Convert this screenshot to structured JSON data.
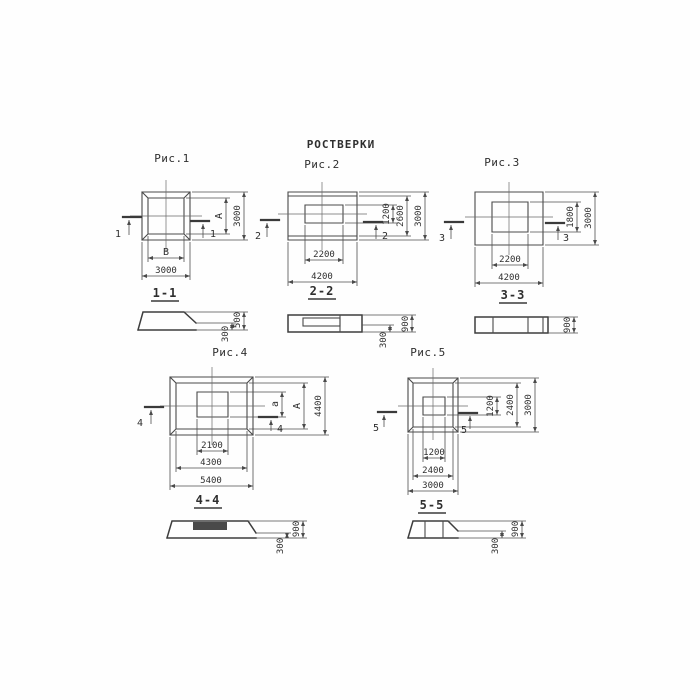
{
  "title": "РОСТВЕРКИ",
  "colors": {
    "background": "#fefefe",
    "line": "#4a4a4a",
    "text": "#2e2e2e"
  },
  "fig1": {
    "label": "Рис.1",
    "cut": "1",
    "section_title": "1-1",
    "plan_dims": {
      "inner_width": "В",
      "outer_width": "3000",
      "inner_height": "А",
      "outer_height": "3000"
    },
    "section_dims": {
      "total_height": "500",
      "ledge_height": "300"
    }
  },
  "fig2": {
    "label": "Рис.2",
    "cut": "2",
    "section_title": "2-2",
    "plan_dims": {
      "inner_width": "2200",
      "outer_width": "4200",
      "inner_height": "1200",
      "mid_height": "2600",
      "outer_height": "3000"
    },
    "section_dims": {
      "total_height": "900",
      "ledge_height": "300"
    }
  },
  "fig3": {
    "label": "Рис.3",
    "cut": "3",
    "section_title": "3-3",
    "plan_dims": {
      "inner_width": "2200",
      "outer_width": "4200",
      "inner_height": "1800",
      "outer_height": "3000"
    },
    "section_dims": {
      "total_height": "900"
    }
  },
  "fig4": {
    "label": "Рис.4",
    "cut": "4",
    "section_title": "4-4",
    "plan_dims": {
      "inner_width": "2100",
      "mid_width": "4300",
      "outer_width": "5400",
      "inner_height": "а",
      "mid_height": "А",
      "outer_height": "4400"
    },
    "section_dims": {
      "total_height": "900",
      "ledge_height": "300"
    }
  },
  "fig5": {
    "label": "Рис.5",
    "cut": "5",
    "section_title": "5-5",
    "plan_dims": {
      "inner_width": "1200",
      "mid_width": "2400",
      "outer_width": "3000",
      "inner_height": "1200",
      "mid_height": "2400",
      "outer_height": "3000"
    },
    "section_dims": {
      "total_height": "900",
      "ledge_height": "300"
    }
  }
}
